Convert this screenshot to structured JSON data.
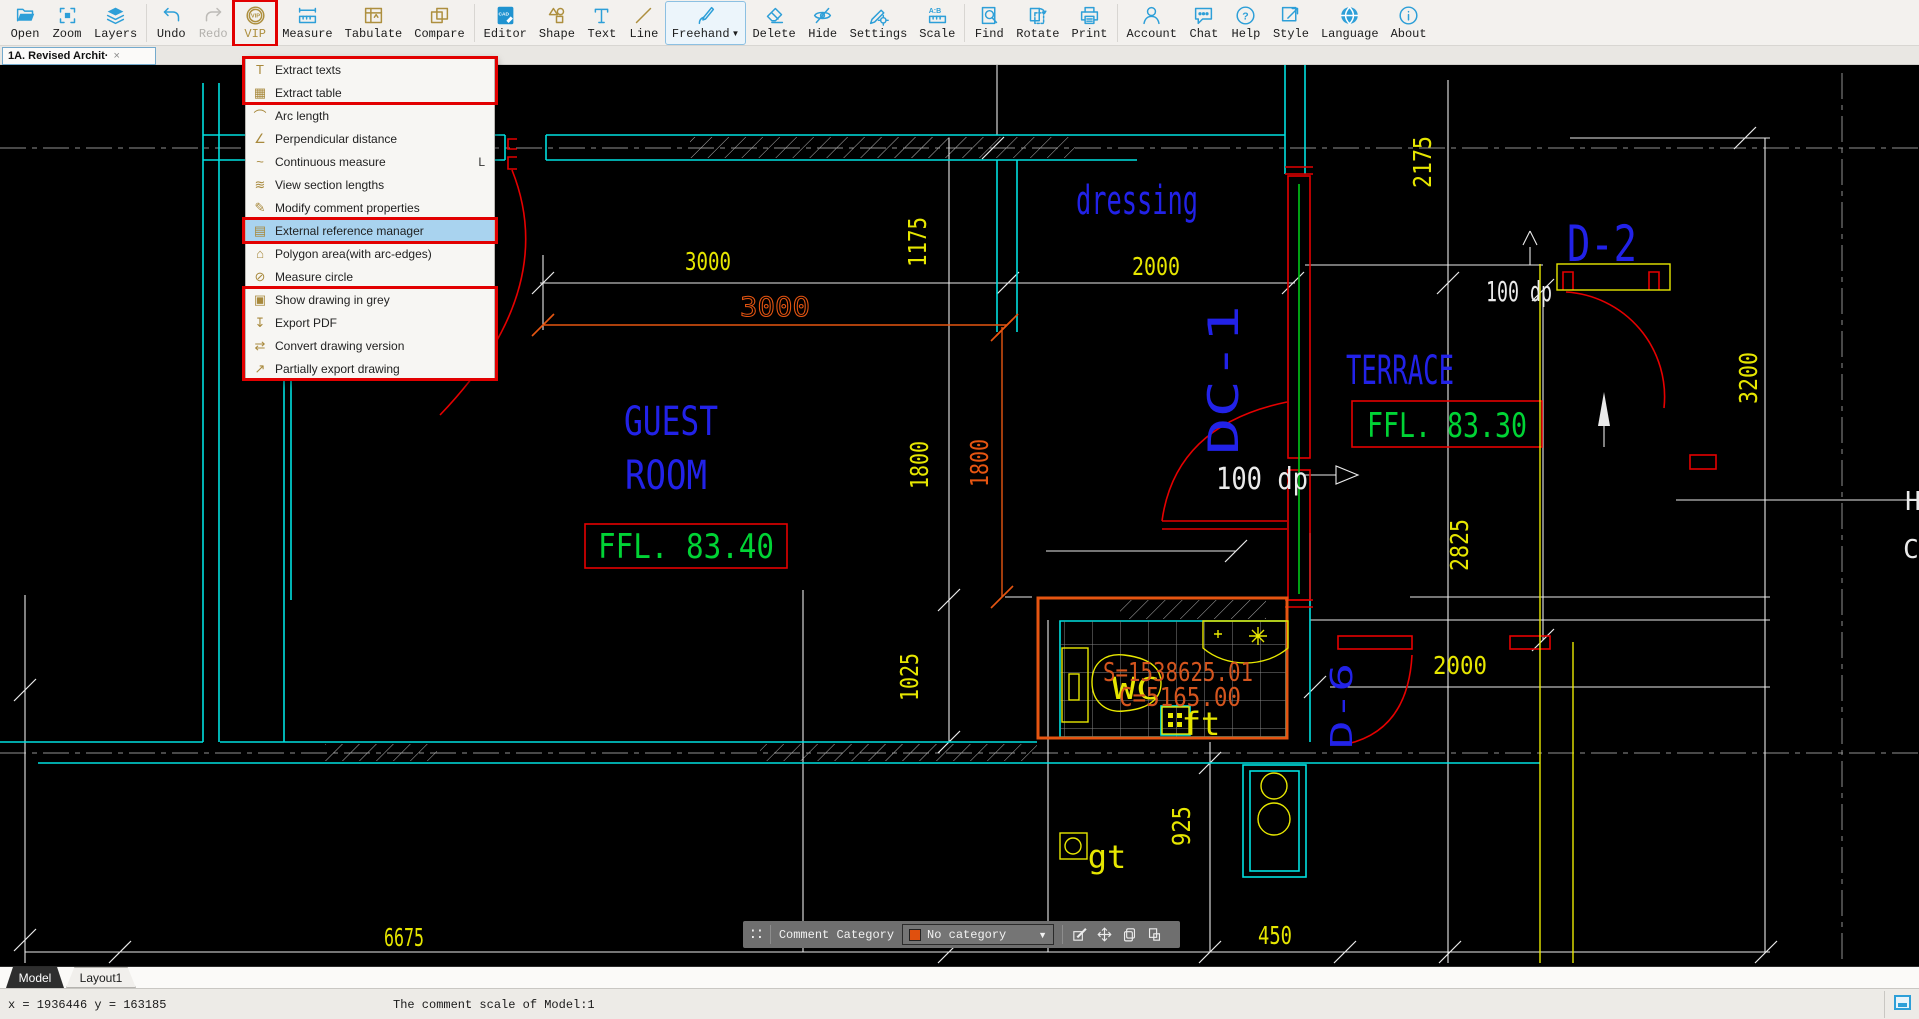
{
  "toolbar": {
    "freehand_caret": "▼",
    "items": [
      {
        "label": "Open"
      },
      {
        "label": "Zoom"
      },
      {
        "label": "Layers"
      },
      {
        "label": "Undo"
      },
      {
        "label": "Redo"
      },
      {
        "label": "VIP"
      },
      {
        "label": "Measure"
      },
      {
        "label": "Tabulate"
      },
      {
        "label": "Compare"
      },
      {
        "label": "Editor"
      },
      {
        "label": "Shape"
      },
      {
        "label": "Text"
      },
      {
        "label": "Line"
      },
      {
        "label": "Freehand"
      },
      {
        "label": "Delete"
      },
      {
        "label": "Hide"
      },
      {
        "label": "Settings"
      },
      {
        "label": "Scale"
      },
      {
        "label": "Find"
      },
      {
        "label": "Rotate"
      },
      {
        "label": "Print"
      },
      {
        "label": "Account"
      },
      {
        "label": "Chat"
      },
      {
        "label": "Help"
      },
      {
        "label": "Style"
      },
      {
        "label": "Language"
      },
      {
        "label": "About"
      }
    ]
  },
  "doc_tab": {
    "title": "1A. Revised Archit·",
    "close_glyph": "×"
  },
  "menu": {
    "items": [
      {
        "icon": "T",
        "label": "Extract texts"
      },
      {
        "icon": "▦",
        "label": "Extract table"
      },
      {
        "icon": "⌒",
        "label": "Arc length"
      },
      {
        "icon": "∠",
        "label": "Perpendicular distance"
      },
      {
        "icon": "~",
        "label": "Continuous measure",
        "shortcut": "L"
      },
      {
        "icon": "≋",
        "label": "View section lengths"
      },
      {
        "icon": "✎",
        "label": "Modify comment properties"
      },
      {
        "icon": "▤",
        "label": "External reference manager"
      },
      {
        "icon": "⌂",
        "label": "Polygon area(with arc-edges)"
      },
      {
        "icon": "⊘",
        "label": "Measure circle"
      },
      {
        "icon": "▣",
        "label": "Show drawing in grey"
      },
      {
        "icon": "↧",
        "label": "Export PDF"
      },
      {
        "icon": "⇄",
        "label": "Convert drawing version"
      },
      {
        "icon": "↗",
        "label": "Partially export drawing"
      }
    ]
  },
  "drawing": {
    "dims": {
      "d3000_top": "3000",
      "d1175": "1175",
      "d2000_top": "2000",
      "d2175": "2175",
      "d3000_orange": "3000",
      "d1800_orange": "1800",
      "d1800": "1800",
      "d1025": "1025",
      "d925": "925",
      "d6675": "6675",
      "d450": "450",
      "d2825": "2825",
      "d3200": "3200",
      "d2000_right": "2000",
      "dp_top": "100 dp",
      "dp_mid": "100 dp"
    },
    "rooms": {
      "dressing": "dressing",
      "guest_1": "GUEST",
      "guest_2": "ROOM",
      "terrace": "TERRACE"
    },
    "doors": {
      "d2": "D-2",
      "dc1": "DC-1",
      "d6": "D-6"
    },
    "levels": {
      "guest": "FFL. 83.40",
      "terrace": "FFL. 83.30"
    },
    "annotations": {
      "area": "S=1538625.01",
      "circumference": "C=5165.00",
      "wc": "WC",
      "ft": "ft",
      "gt": "gt",
      "cut_h": "H",
      "cut_c": "C"
    }
  },
  "comment_bar": {
    "label": "Comment Category",
    "selected_category": "No category",
    "caret": "▼",
    "grip": "∷"
  },
  "sheet_tabs": {
    "model": "Model",
    "layout1": "Layout1"
  },
  "status_bar": {
    "coordinates": "x = 1936446 y = 163185",
    "message": "The comment scale of Model:1"
  },
  "colors": {
    "accent_blue": "#2d9fd8",
    "gold": "#ad8f3e",
    "annotation_red": "#e20000",
    "selection_orange": "#e65511"
  }
}
